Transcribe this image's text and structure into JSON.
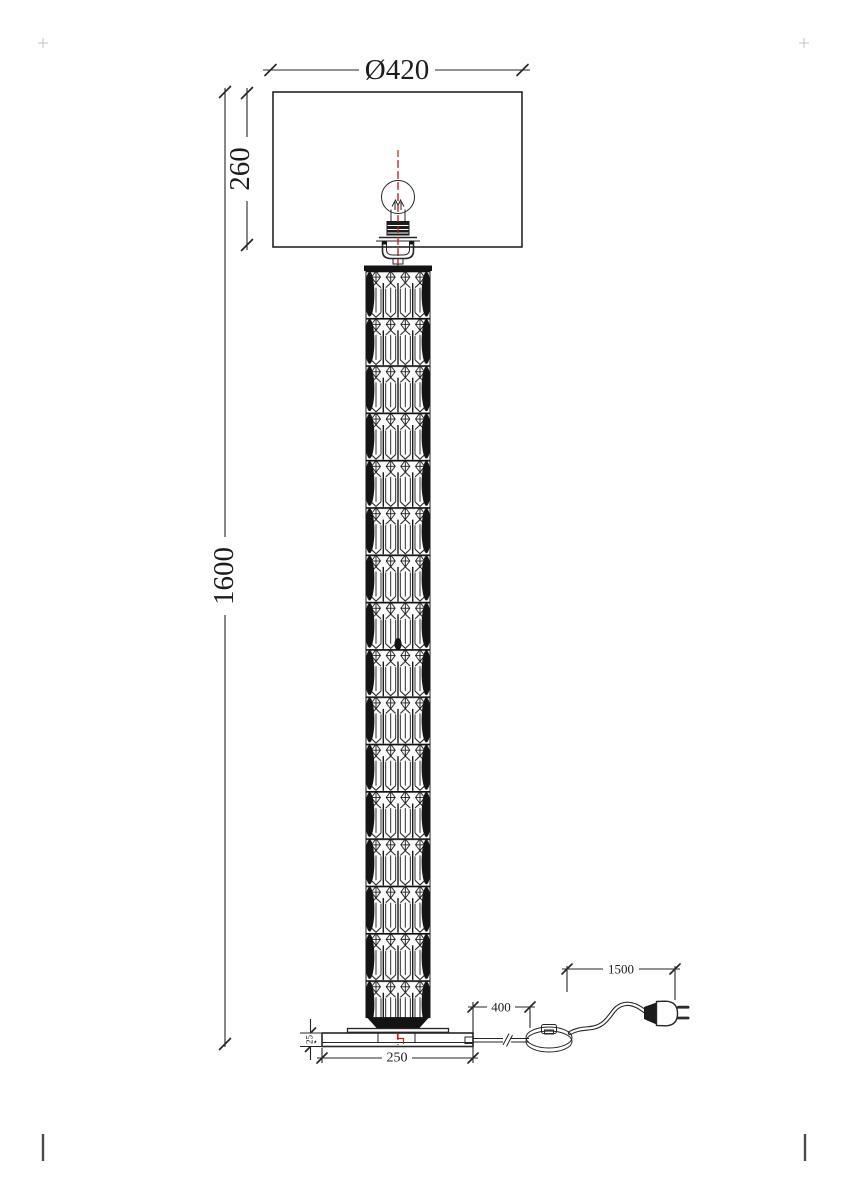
{
  "page": {
    "background_color": "#ffffff"
  },
  "drawing": {
    "kind": "technical dimension drawing",
    "subject": "crystal floor lamp, front elevation",
    "stroke_color": "#262626",
    "centerline_color": "#c41f1f",
    "dimensions": {
      "shade_diameter": {
        "label": "Ø420",
        "value": 420
      },
      "shade_height": {
        "label": "260",
        "value": 260
      },
      "total_height": {
        "label": "1600",
        "value": 1600
      },
      "base_thickness": {
        "label": "25",
        "value": 25
      },
      "base_width": {
        "label": "250",
        "value": 250
      },
      "base_to_switch_cord": {
        "label": "400",
        "value": 400
      },
      "switch_to_plug_cord": {
        "label": "1500",
        "value": 1500
      }
    },
    "parts": [
      {
        "name": "lampshade"
      },
      {
        "name": "light-bulb"
      },
      {
        "name": "lamp-holder"
      },
      {
        "name": "crystal-column"
      },
      {
        "name": "base-plate"
      },
      {
        "name": "power-cord"
      },
      {
        "name": "foot-switch"
      },
      {
        "name": "power-plug"
      }
    ]
  }
}
